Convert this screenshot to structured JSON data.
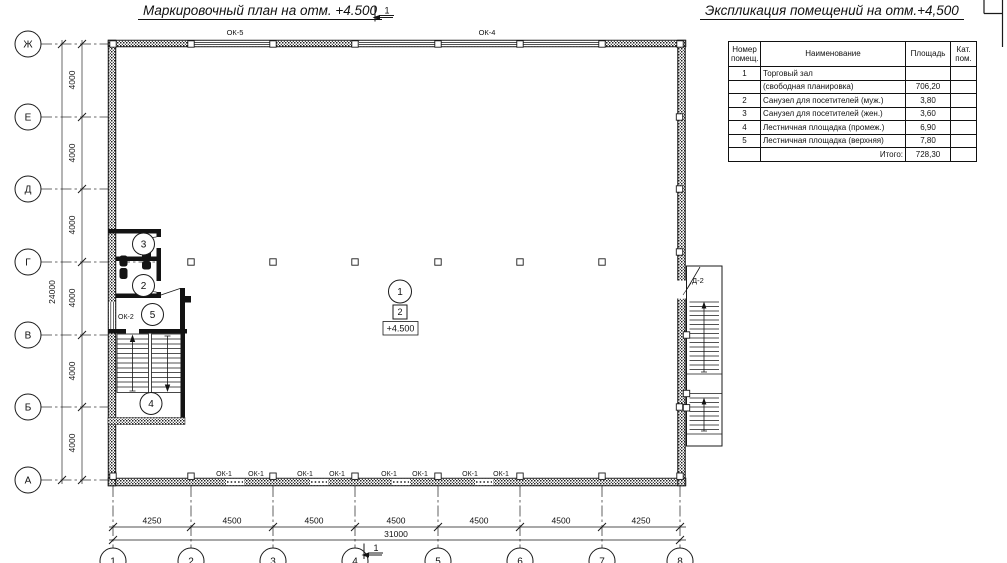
{
  "colors": {
    "line": "#1a1a1a",
    "background": "#ffffff"
  },
  "titles": {
    "plan": "Маркировочный план на отм. +4.500",
    "explication": "Экспликация помещений на отм.+4,500"
  },
  "section_mark": {
    "label": "1"
  },
  "grid": {
    "rows": [
      "Ж",
      "Е",
      "Д",
      "Г",
      "В",
      "Б",
      "А"
    ],
    "cols": [
      "1",
      "2",
      "3",
      "4",
      "5",
      "6",
      "7",
      "8"
    ]
  },
  "dimensions": {
    "left": [
      "4000",
      "4000",
      "4000",
      "4000",
      "4000",
      "4000"
    ],
    "left_total": "24000",
    "bottom": [
      "4250",
      "4500",
      "4500",
      "4500",
      "4500",
      "4500",
      "4250"
    ],
    "bottom_total": "31000"
  },
  "labels": {
    "ok5": "ОК-5",
    "ok4": "ОК-4",
    "ok1": "ОК-1",
    "ok2": "ОК-2",
    "d2": "Д-2",
    "elevation": "+4.500",
    "floor_type": "2"
  },
  "rooms": [
    "1",
    "2",
    "3",
    "4",
    "5"
  ],
  "explication_table": {
    "headers": {
      "num": "Номер\nпомещ.",
      "name": "Наименование",
      "area": "Площадь",
      "cat": "Кат.\nпом."
    },
    "rows": [
      {
        "num": "1",
        "name": "Торговый зал",
        "area": "",
        "cat": ""
      },
      {
        "num": "",
        "name": "(свободная планировка)",
        "area": "706,20",
        "cat": ""
      },
      {
        "num": "2",
        "name": "Санузел для посетителей (муж.)",
        "area": "3,80",
        "cat": ""
      },
      {
        "num": "3",
        "name": "Санузел для посетителей (жен.)",
        "area": "3,60",
        "cat": ""
      },
      {
        "num": "4",
        "name": "Лестничная площадка (промеж.)",
        "area": "6,90",
        "cat": ""
      },
      {
        "num": "5",
        "name": "Лестничная площадка (верхняя)",
        "area": "7,80",
        "cat": ""
      },
      {
        "num": "",
        "name": "Итого:",
        "area": "728,30",
        "cat": ""
      }
    ]
  }
}
